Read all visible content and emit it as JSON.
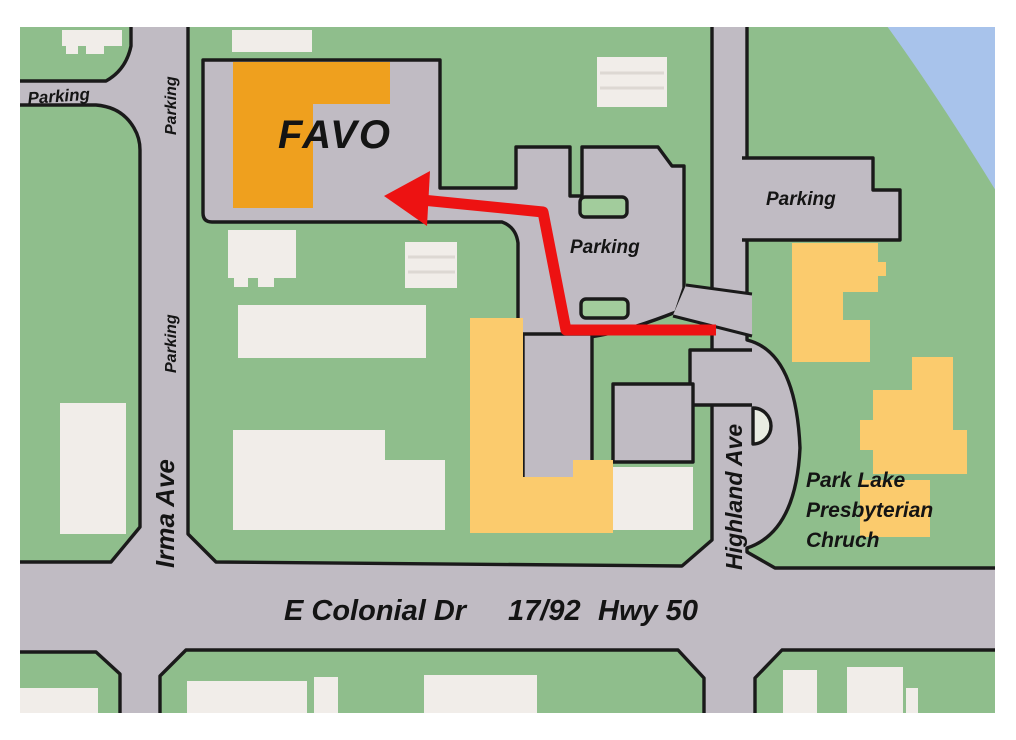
{
  "map": {
    "favo_label": "FAVO",
    "labels": {
      "parking_nw": "Parking",
      "parking_irma_north": "Parking",
      "parking_irma_mid": "Parking",
      "parking_central": "Parking",
      "parking_east": "Parking",
      "irma_ave": "Irma Ave",
      "highland_ave": "Highland Ave",
      "colonial_dr": "E Colonial Dr",
      "colonial_route": "17/92",
      "colonial_hwy": "Hwy 50",
      "church_line1": "Park Lake",
      "church_line2": "Presbyterian",
      "church_line3": "Chruch"
    },
    "colors": {
      "land_green": "#8fbe8c",
      "road_gray": "#c0bbc3",
      "outline_black": "#1a1a1a",
      "favo_orange": "#efa01e",
      "building_white": "#f1ede9",
      "building_tan": "#fbcb6d",
      "water_blue": "#a8c3eb",
      "route_red": "#ed1212",
      "church_text_green": "#16381b",
      "island_green": "#a2cc9c",
      "turnout_pale": "#e9ece2"
    }
  }
}
